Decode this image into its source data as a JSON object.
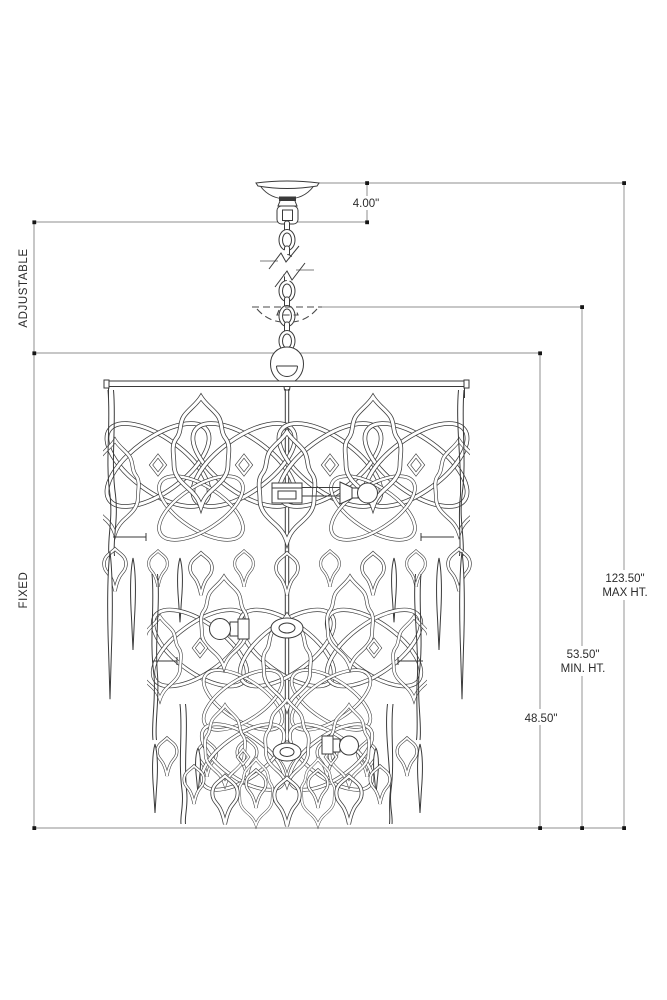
{
  "drawing": {
    "type": "chandelier-dimension-drawing",
    "colors": {
      "background": "#ffffff",
      "artwork_line": "#3a3a3a",
      "dimension_line": "#8f8f8f",
      "dimension_line_light": "#b3b3b3",
      "text": "#2b2b2b"
    },
    "side_labels": {
      "adjustable": "ADJUSTABLE",
      "fixed": "FIXED"
    },
    "dims": {
      "canopy": {
        "value": "4.00\""
      },
      "max": {
        "value": "123.50\"",
        "label": "MAX HT."
      },
      "min": {
        "value": "53.50\"",
        "label": "MIN. HT."
      },
      "fixed": {
        "value": "48.50\""
      }
    }
  }
}
